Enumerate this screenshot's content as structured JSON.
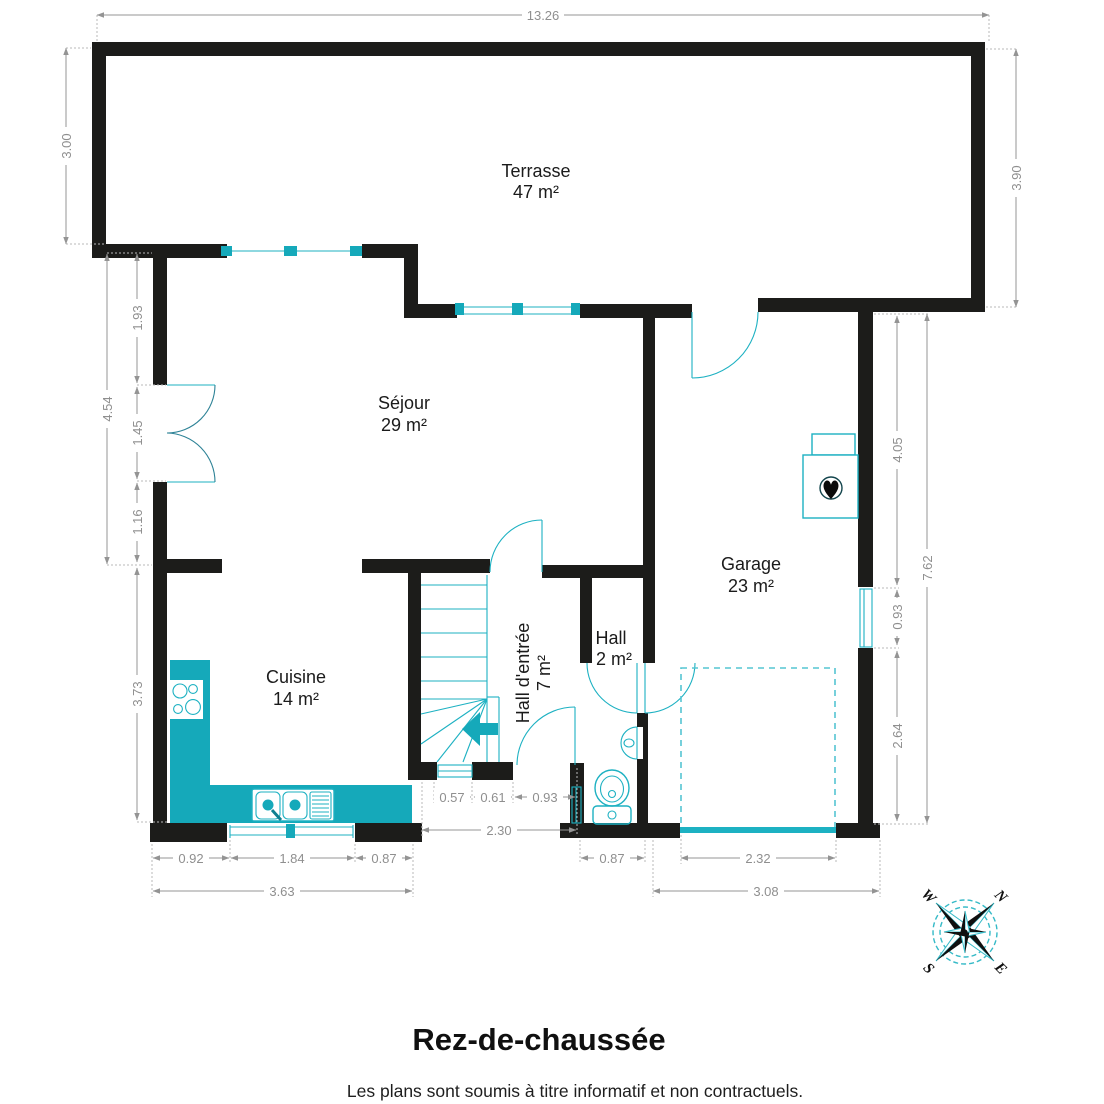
{
  "plan": {
    "title": "Rez-de-chaussée",
    "disclaimer": "Les plans sont soumis à titre informatif et non contractuels.",
    "rooms": {
      "terrasse": {
        "name": "Terrasse",
        "area": "47 m²"
      },
      "sejour": {
        "name": "Séjour",
        "area": "29 m²"
      },
      "garage": {
        "name": "Garage",
        "area": "23 m²"
      },
      "cuisine": {
        "name": "Cuisine",
        "area": "14 m²"
      },
      "hall": {
        "name": "Hall",
        "area": "2 m²"
      },
      "hall_entree": {
        "name": "Hall d'entrée",
        "area": "7 m²"
      }
    },
    "dims": {
      "top": "13.26",
      "t_left": "3.00",
      "t_right": "3.90",
      "s_total": "4.54",
      "s1": "1.93",
      "s2": "1.45",
      "s3": "1.16",
      "k_h": "3.73",
      "g1": "4.05",
      "g_win": "0.93",
      "g2": "2.64",
      "r_total": "7.62",
      "h1": "0.57",
      "h2": "0.61",
      "h3": "0.93",
      "h_total": "2.30",
      "k1": "0.92",
      "k_win": "1.84",
      "k2": "0.87",
      "k_total": "3.63",
      "wc": "0.87",
      "g_door": "2.32",
      "g_total": "3.08"
    },
    "compass": {
      "n": "N",
      "e": "E",
      "s": "S",
      "w": "W"
    },
    "colors": {
      "wall": "#1c1c1a",
      "fixture": "#1db1c2",
      "counter_fill": "#15a9ba",
      "dimension": "#8f8f8f"
    }
  }
}
